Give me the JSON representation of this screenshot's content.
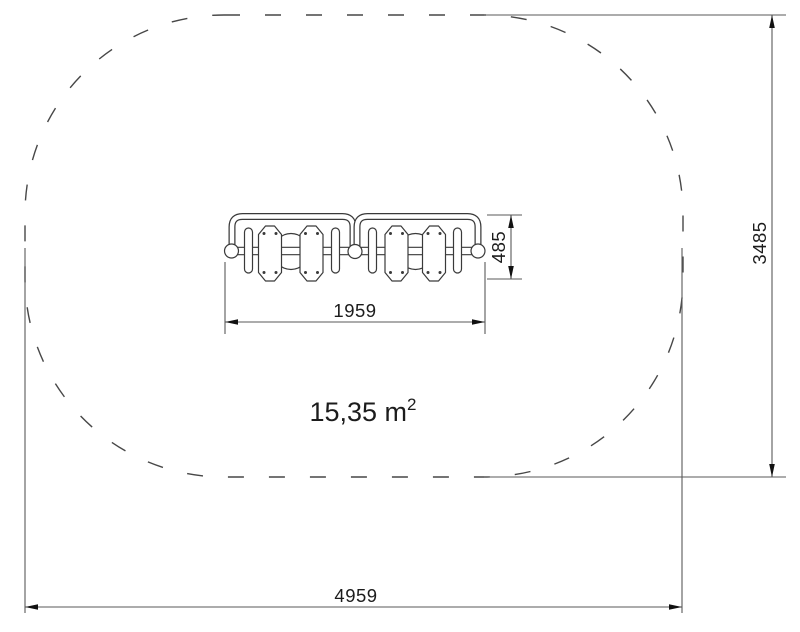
{
  "drawing": {
    "type": "technical plan view, playground equipment safety zone",
    "area_label": {
      "value": "15,35 m",
      "sup": "2"
    },
    "dimensions": {
      "overall_width": "4959",
      "overall_height": "3485",
      "equipment_width": "1959",
      "equipment_height": "485"
    },
    "safety_zone": {
      "shape": "rounded rectangle, dashed outline",
      "width_mm": 4959,
      "height_mm": 3485,
      "corner_radius_mm": 1500,
      "area_m2": "15,35"
    },
    "equipment": {
      "name": "four-seat springer seesaw, top view",
      "seats": 4,
      "handrails": 2,
      "springs": 2
    },
    "colors": {
      "background": "#ffffff",
      "outline": "#474747",
      "drawing_line": "#3a3a3a",
      "dim_line": "#5a5a5a",
      "arrow": "#111111",
      "text": "#1c1c1c"
    }
  }
}
